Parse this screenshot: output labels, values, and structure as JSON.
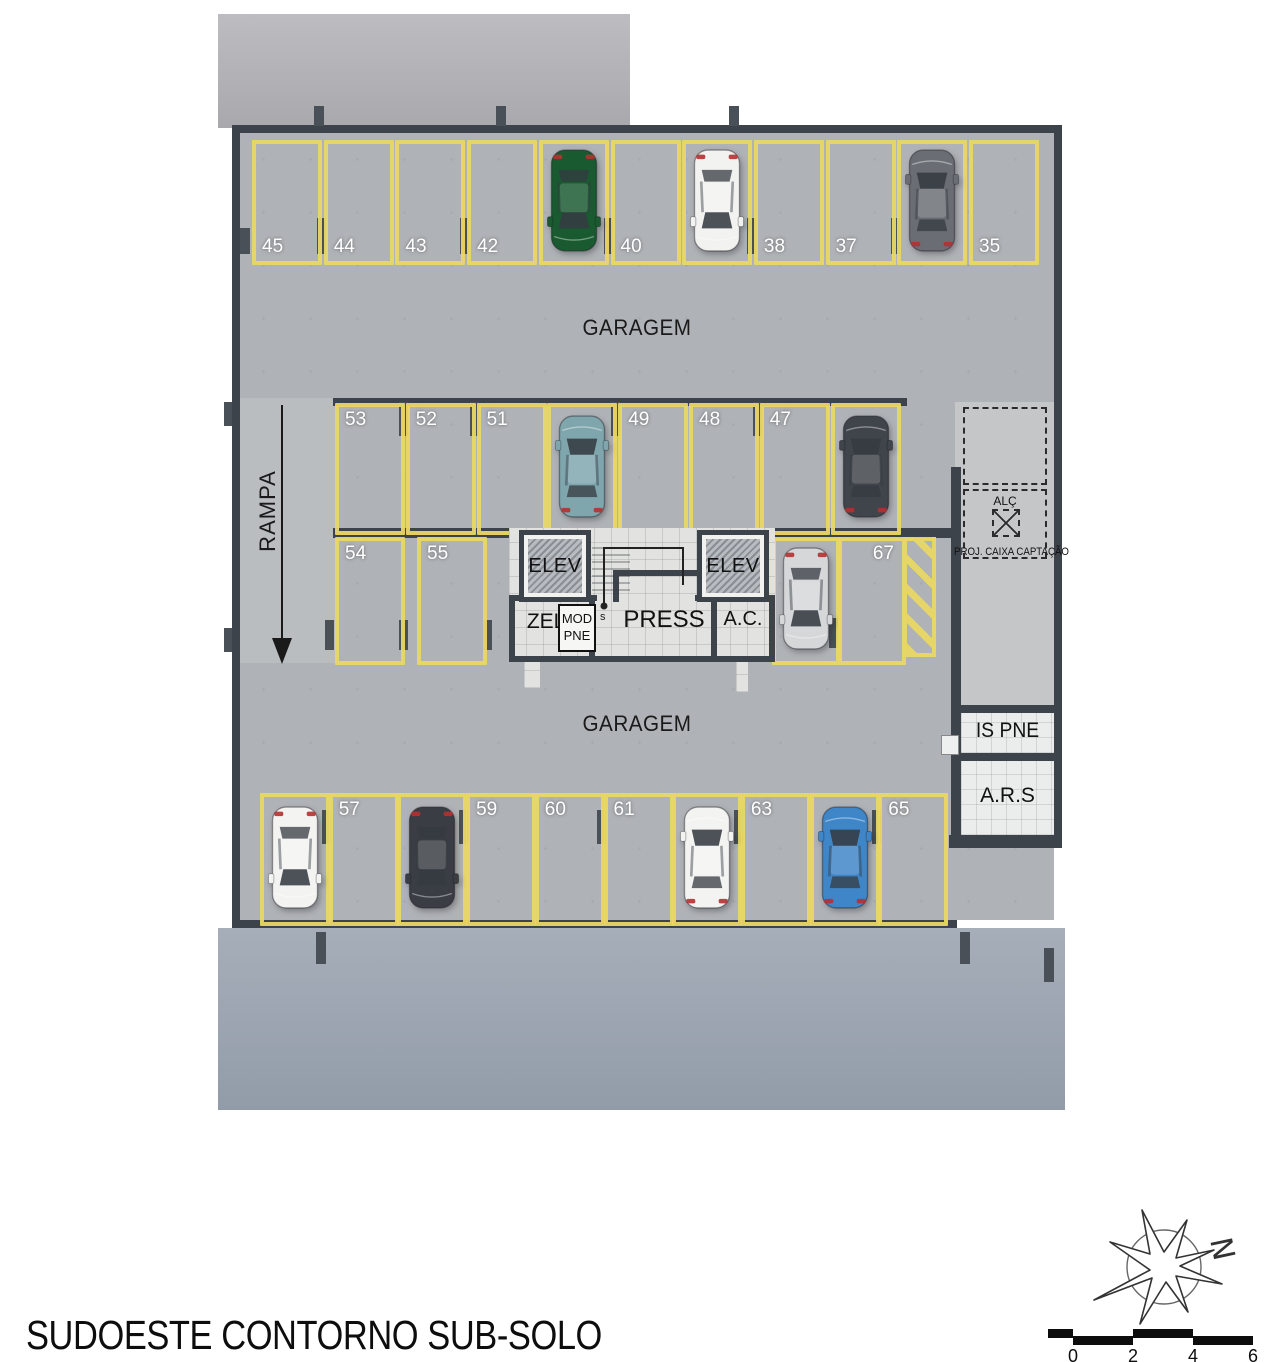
{
  "title": "SUDOESTE CONTORNO SUB-SOLO",
  "labels": {
    "garagem_top": "GARAGEM",
    "garagem_bottom": "GARAGEM",
    "rampa": "RAMPA",
    "stair_start": "s"
  },
  "core": {
    "elev_left": "ELEV",
    "elev_right": "ELEV",
    "zel": "ZEL.",
    "mod_line1": "MOD",
    "mod_line2": "PNE",
    "press": "PRESS",
    "ac": "A.C."
  },
  "right_column": {
    "alc": "ALÇ",
    "proj_caixa": "PROJ. CAIXA CAPTAÇÃO",
    "is_pne": "IS PNE",
    "ars": "A.R.S"
  },
  "rows": {
    "top": {
      "spaces": [
        {
          "label": "45"
        },
        {
          "label": "44"
        },
        {
          "label": "43"
        },
        {
          "label": "42"
        },
        {
          "label": "",
          "car": "green",
          "car_dir": "down"
        },
        {
          "label": "40"
        },
        {
          "label": "",
          "car": "white",
          "car_dir": "down"
        },
        {
          "label": "38"
        },
        {
          "label": "37"
        },
        {
          "label": "",
          "car": "gray",
          "car_dir": "up"
        },
        {
          "label": "35"
        }
      ]
    },
    "middle": {
      "spaces": [
        {
          "label": "53"
        },
        {
          "label": "52"
        },
        {
          "label": "51"
        },
        {
          "label": "",
          "car": "teal",
          "car_dir": "up"
        },
        {
          "label": "49"
        },
        {
          "label": "48"
        },
        {
          "label": "47"
        },
        {
          "label": "",
          "car": "charcoal",
          "car_dir": "up"
        }
      ]
    },
    "lower_left": {
      "spaces": [
        {
          "label": "54"
        },
        {
          "label": "55"
        }
      ]
    },
    "lower_right": {
      "spaces": [
        {
          "label": "",
          "car": "silver",
          "car_dir": "down"
        },
        {
          "label": "67"
        }
      ]
    },
    "bottom": {
      "spaces": [
        {
          "label": "",
          "car": "white2",
          "car_dir": "down"
        },
        {
          "label": "57"
        },
        {
          "label": "",
          "car": "charcoal2",
          "car_dir": "down"
        },
        {
          "label": "59"
        },
        {
          "label": "60"
        },
        {
          "label": "61"
        },
        {
          "label": "",
          "car": "white3",
          "car_dir": "up"
        },
        {
          "label": "63"
        },
        {
          "label": "",
          "car": "blue",
          "car_dir": "up"
        },
        {
          "label": "65"
        }
      ]
    }
  },
  "car_colors": {
    "green": "#1a5a30",
    "white": "#f2f2f1",
    "gray": "#6a6e74",
    "teal": "#7fa6ad",
    "charcoal": "#40444b",
    "silver": "#d5d7d9",
    "white2": "#f3f3f2",
    "charcoal2": "#3a3e44",
    "white3": "#f3f3f2",
    "blue": "#3f86c8"
  },
  "compass": {
    "north": "N"
  },
  "scale_bar": {
    "ticks": [
      "0",
      "2",
      "4",
      "6"
    ]
  },
  "colors": {
    "parking_line": "#e9d765",
    "wall": "#3d434b",
    "floor": "#afb2b6",
    "apron": "#9aa3b0",
    "tile": "#e2e3e1"
  }
}
